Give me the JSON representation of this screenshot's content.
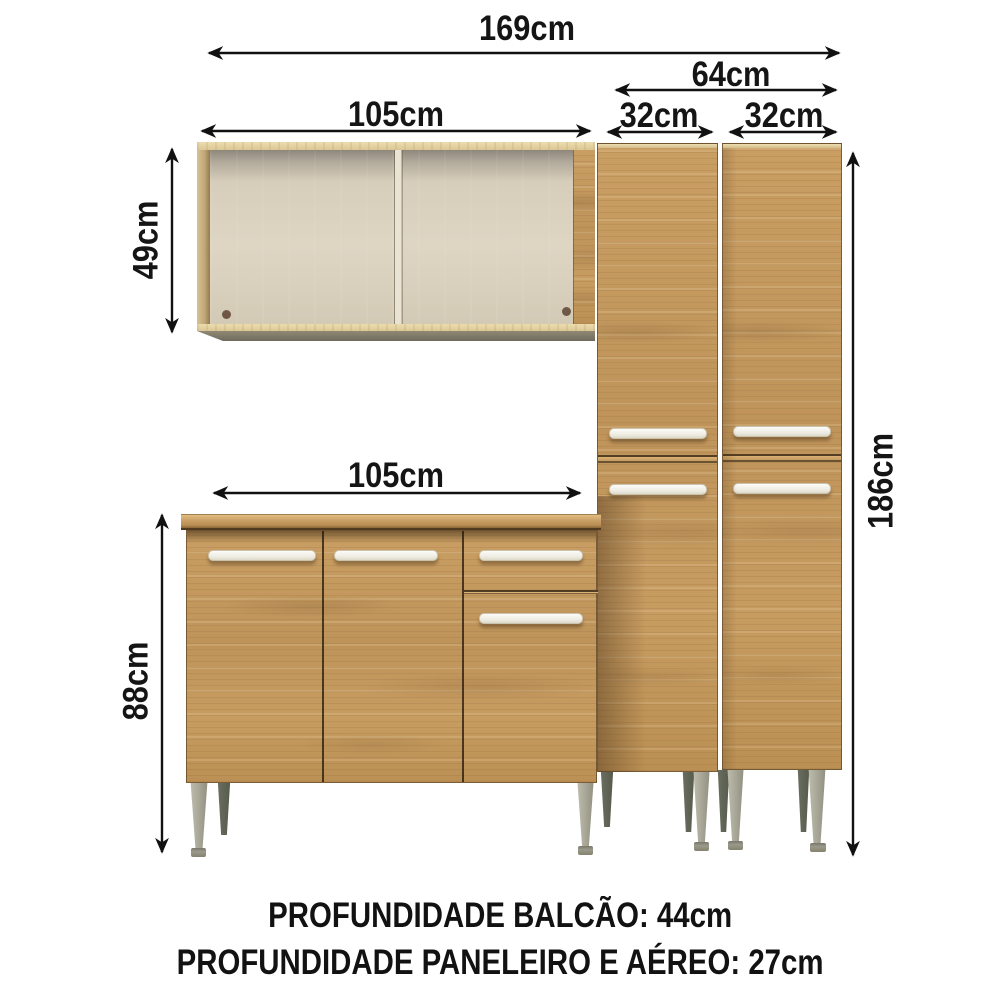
{
  "diagram": {
    "title_context": "kitchen cabinet set dimension diagram",
    "labels": {
      "total_width": "169cm",
      "towers_width": "64cm",
      "tower_left_width": "32cm",
      "tower_right_width": "32cm",
      "upper_cabinet_width": "105cm",
      "upper_cabinet_height": "49cm",
      "counter_width": "105cm",
      "counter_height": "88cm",
      "tower_height": "186cm"
    },
    "footer": {
      "line1": "PROFUNDIDADE BALCÃO: 44cm",
      "line2": "PROFUNDIDADE PANELEIRO E AÉREO: 27cm"
    },
    "colors": {
      "background": "#ffffff",
      "wood": "#c49a5f",
      "wood_light": "#e3d2a4",
      "countertop": "#cda267",
      "interior": "#d9d0bd",
      "handle": "#f3f1ea",
      "leg_front": "#a9a899",
      "leg_back": "#64685c",
      "dimension_line": "#111111"
    }
  }
}
